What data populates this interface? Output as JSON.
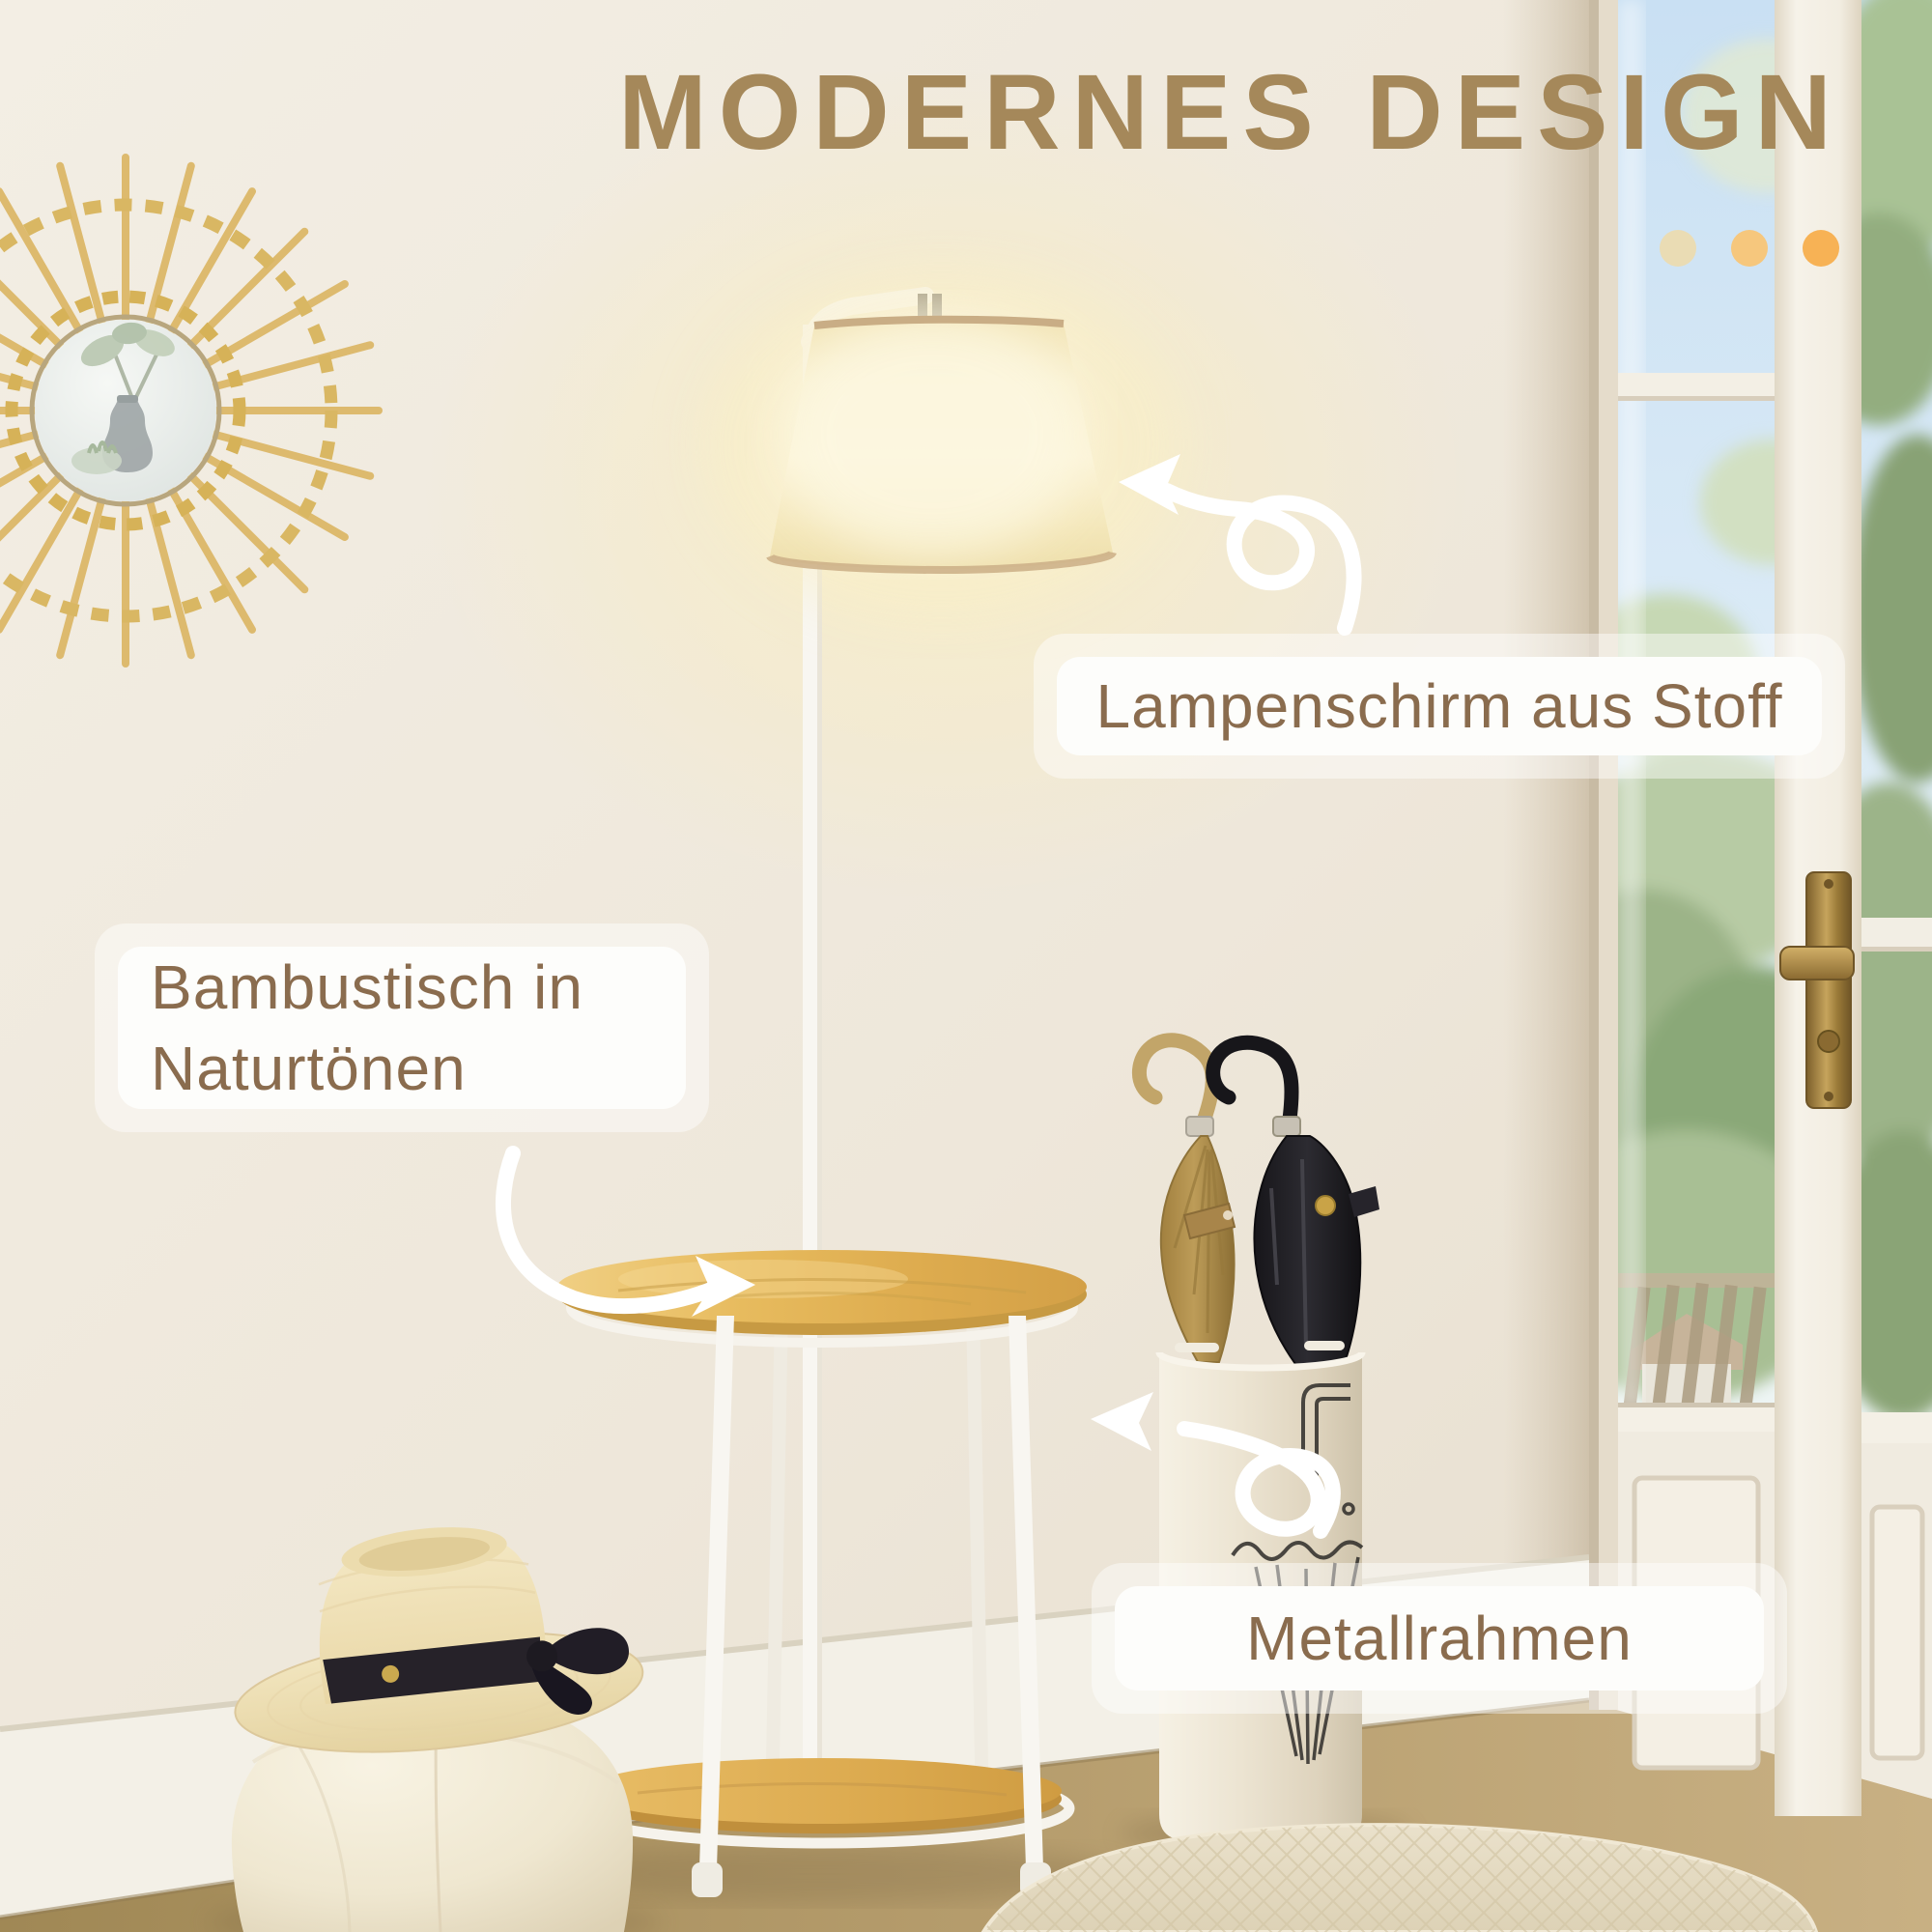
{
  "title": {
    "text": "MODERNES DESIGN",
    "color": "#a5885a"
  },
  "decor_dots": [
    {
      "color": "#eadcb4"
    },
    {
      "color": "#f6c77d"
    },
    {
      "color": "#f7b255"
    }
  ],
  "callouts": {
    "lampshade": {
      "text": "Lampenschirm aus Stoff"
    },
    "table": {
      "line1": "Bambustisch in",
      "line2": "Naturtönen"
    },
    "frame": {
      "text": "Metallrahmen"
    }
  },
  "colors": {
    "label_text": "#8a6c4e",
    "label_background": "#fdfdfb",
    "arrow": "#ffffff",
    "wall": "#efe8dc",
    "bamboo": "#e0b057",
    "lamp_glow": "#fbf3d6"
  }
}
